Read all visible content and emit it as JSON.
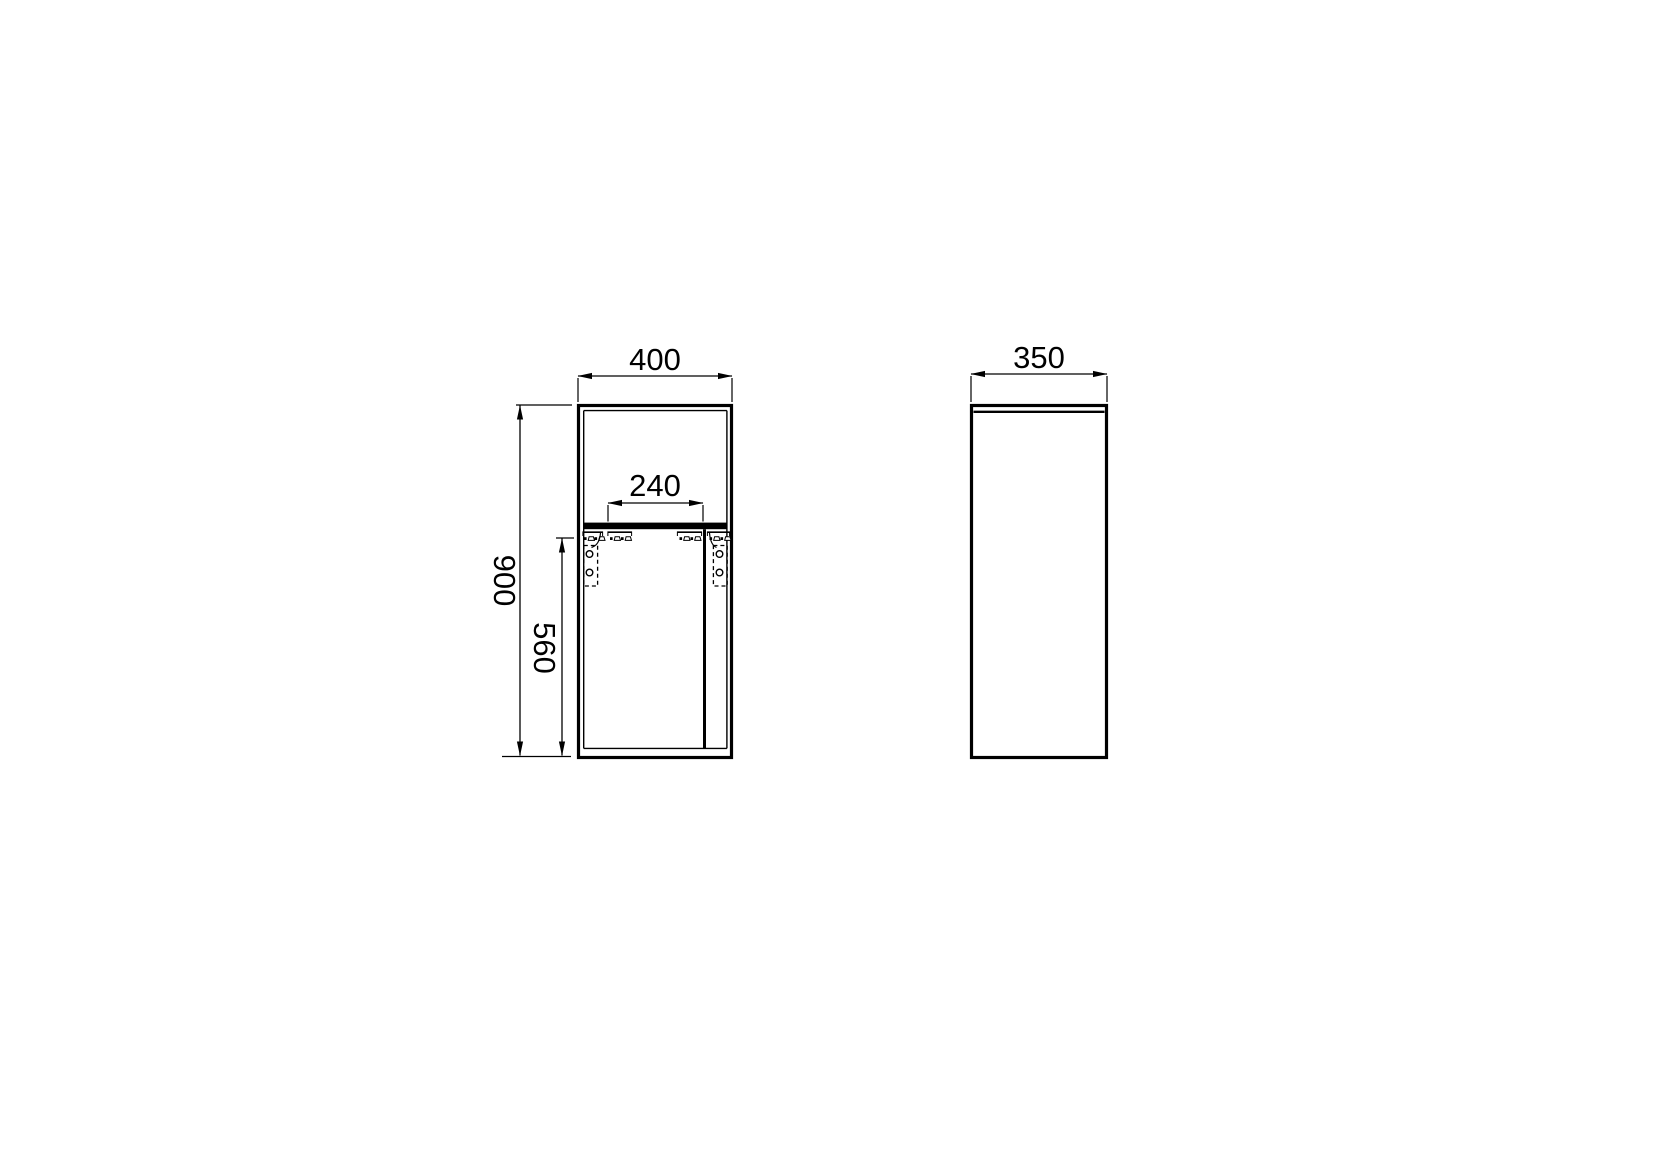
{
  "drawing": {
    "kind": "furniture-technical-drawing",
    "colors": {
      "line": "#000000",
      "background": "#ffffff"
    },
    "views": {
      "front": {
        "label": "front-view",
        "dims": {
          "overall_width": "400",
          "overall_height": "900",
          "lower_door_height": "560",
          "inner_shelf_width": "240"
        }
      },
      "side": {
        "label": "side-view",
        "dims": {
          "overall_depth": "350"
        }
      }
    }
  }
}
